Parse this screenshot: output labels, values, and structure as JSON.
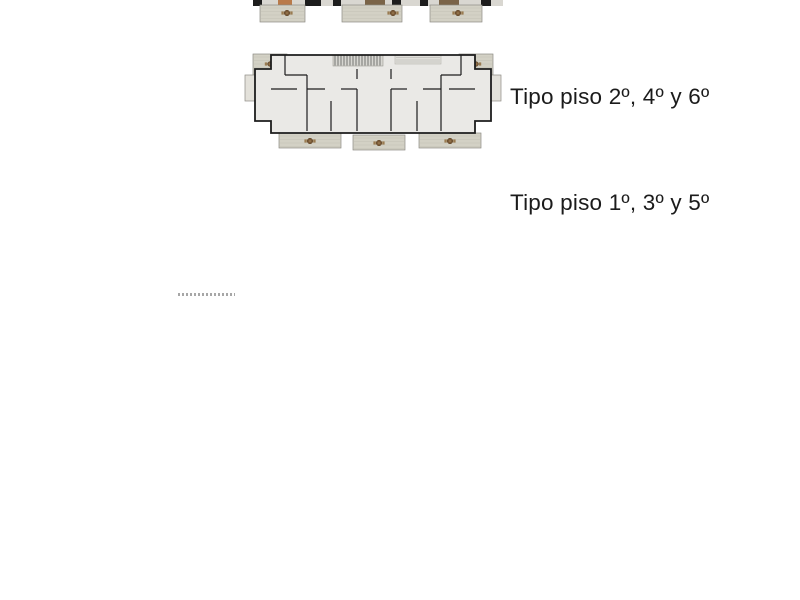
{
  "page": {
    "background": "#ffffff",
    "content": "architectural floor plans and ground site plan"
  },
  "floor_plans": [
    {
      "id": "atico-partial",
      "label": "",
      "note": "top plan cropped at image edge"
    },
    {
      "id": "type-246",
      "label": "Tipo piso 2º, 4º y 6º"
    },
    {
      "id": "type-135",
      "label": "Tipo piso 1º, 3º y 5º"
    }
  ],
  "site_plan": {
    "caption_microtext_legible": false,
    "stalls": [
      {
        "n": "1",
        "x": 105,
        "y": 57
      },
      {
        "n": "2",
        "x": 138,
        "y": 57
      },
      {
        "n": "3",
        "x": 181,
        "y": 57
      },
      {
        "n": "4",
        "x": 220,
        "y": 57
      },
      {
        "n": "5",
        "x": 297,
        "y": 57
      },
      {
        "n": "7",
        "x": 336,
        "y": 55
      },
      {
        "n": "8",
        "x": 336,
        "y": 80
      },
      {
        "n": "23",
        "x": 341,
        "y": 120
      },
      {
        "n": "21",
        "x": 341,
        "y": 172
      },
      {
        "n": "19",
        "x": 341,
        "y": 222
      },
      {
        "n": "10",
        "x": 424,
        "y": 46
      },
      {
        "n": "12",
        "x": 424,
        "y": 89
      },
      {
        "n": "13",
        "x": 424,
        "y": 111
      },
      {
        "n": "14",
        "x": 424,
        "y": 132
      },
      {
        "n": "15",
        "x": 424,
        "y": 155
      },
      {
        "n": "17",
        "x": 424,
        "y": 198
      }
    ],
    "cars": [
      {
        "color": "red",
        "x": 132,
        "y": 25,
        "len": 34,
        "wid": 14,
        "rot": 0,
        "loc": "street"
      },
      {
        "color": "silver",
        "x": 263,
        "y": 57,
        "len": 40,
        "wid": 15,
        "rot": 31,
        "loc": "driveway"
      },
      {
        "color": "blue",
        "x": 418,
        "y": 20,
        "len": 40,
        "wid": 17,
        "rot": 0,
        "loc": "right-row"
      },
      {
        "color": "dark",
        "x": 417,
        "y": 67,
        "len": 44,
        "wid": 17,
        "rot": 0,
        "loc": "right-row"
      },
      {
        "color": "blue",
        "x": 418,
        "y": 176,
        "len": 40,
        "wid": 17,
        "rot": 0,
        "loc": "right-row"
      },
      {
        "color": "dark",
        "x": 418,
        "y": 220,
        "len": 44,
        "wid": 17,
        "rot": 0,
        "loc": "right-row"
      },
      {
        "color": "red",
        "x": 342,
        "y": 153,
        "len": 35,
        "wid": 15,
        "rot": 0,
        "loc": "mid-row"
      },
      {
        "color": "blue",
        "x": 340,
        "y": 194,
        "len": 39,
        "wid": 17,
        "rot": 0,
        "loc": "mid-row"
      }
    ],
    "car_colors": {
      "red": {
        "body": "#d6281c",
        "edge": "#7e120b",
        "glass": "#2a2a2e",
        "roof": "#ee8d84"
      },
      "blue": {
        "body": "#1f46d2",
        "edge": "#10246b",
        "glass": "#131b3c",
        "roof": "#3f66e0"
      },
      "silver": {
        "body": "#c6c7c4",
        "edge": "#858683",
        "glass": "#4e5256",
        "roof": "#dadbd8"
      },
      "dark": {
        "body": "#46474a",
        "edge": "#202124",
        "glass": "#1c1d1f",
        "roof": "#5a5b5e"
      }
    },
    "palms": {
      "count": 4,
      "x": 68,
      "ys": [
        121,
        152,
        184,
        218
      ]
    },
    "loungers": {
      "count": 4
    },
    "pool": {
      "water": "#5abec9"
    },
    "colors": {
      "asphalt": "#57585a",
      "concrete": "#c9c8c4",
      "grass": "#b6bc92",
      "deck": "#a5a39d",
      "building": "#f7f6f3",
      "border": "#000000"
    }
  },
  "plan_colors": {
    "interior": "#eae9e6",
    "wall": "#1d1d1d",
    "terrace": "#d3d1c5",
    "bed": "#b3bfc9",
    "sofa": "#85714f",
    "accent": "#c06b35"
  }
}
